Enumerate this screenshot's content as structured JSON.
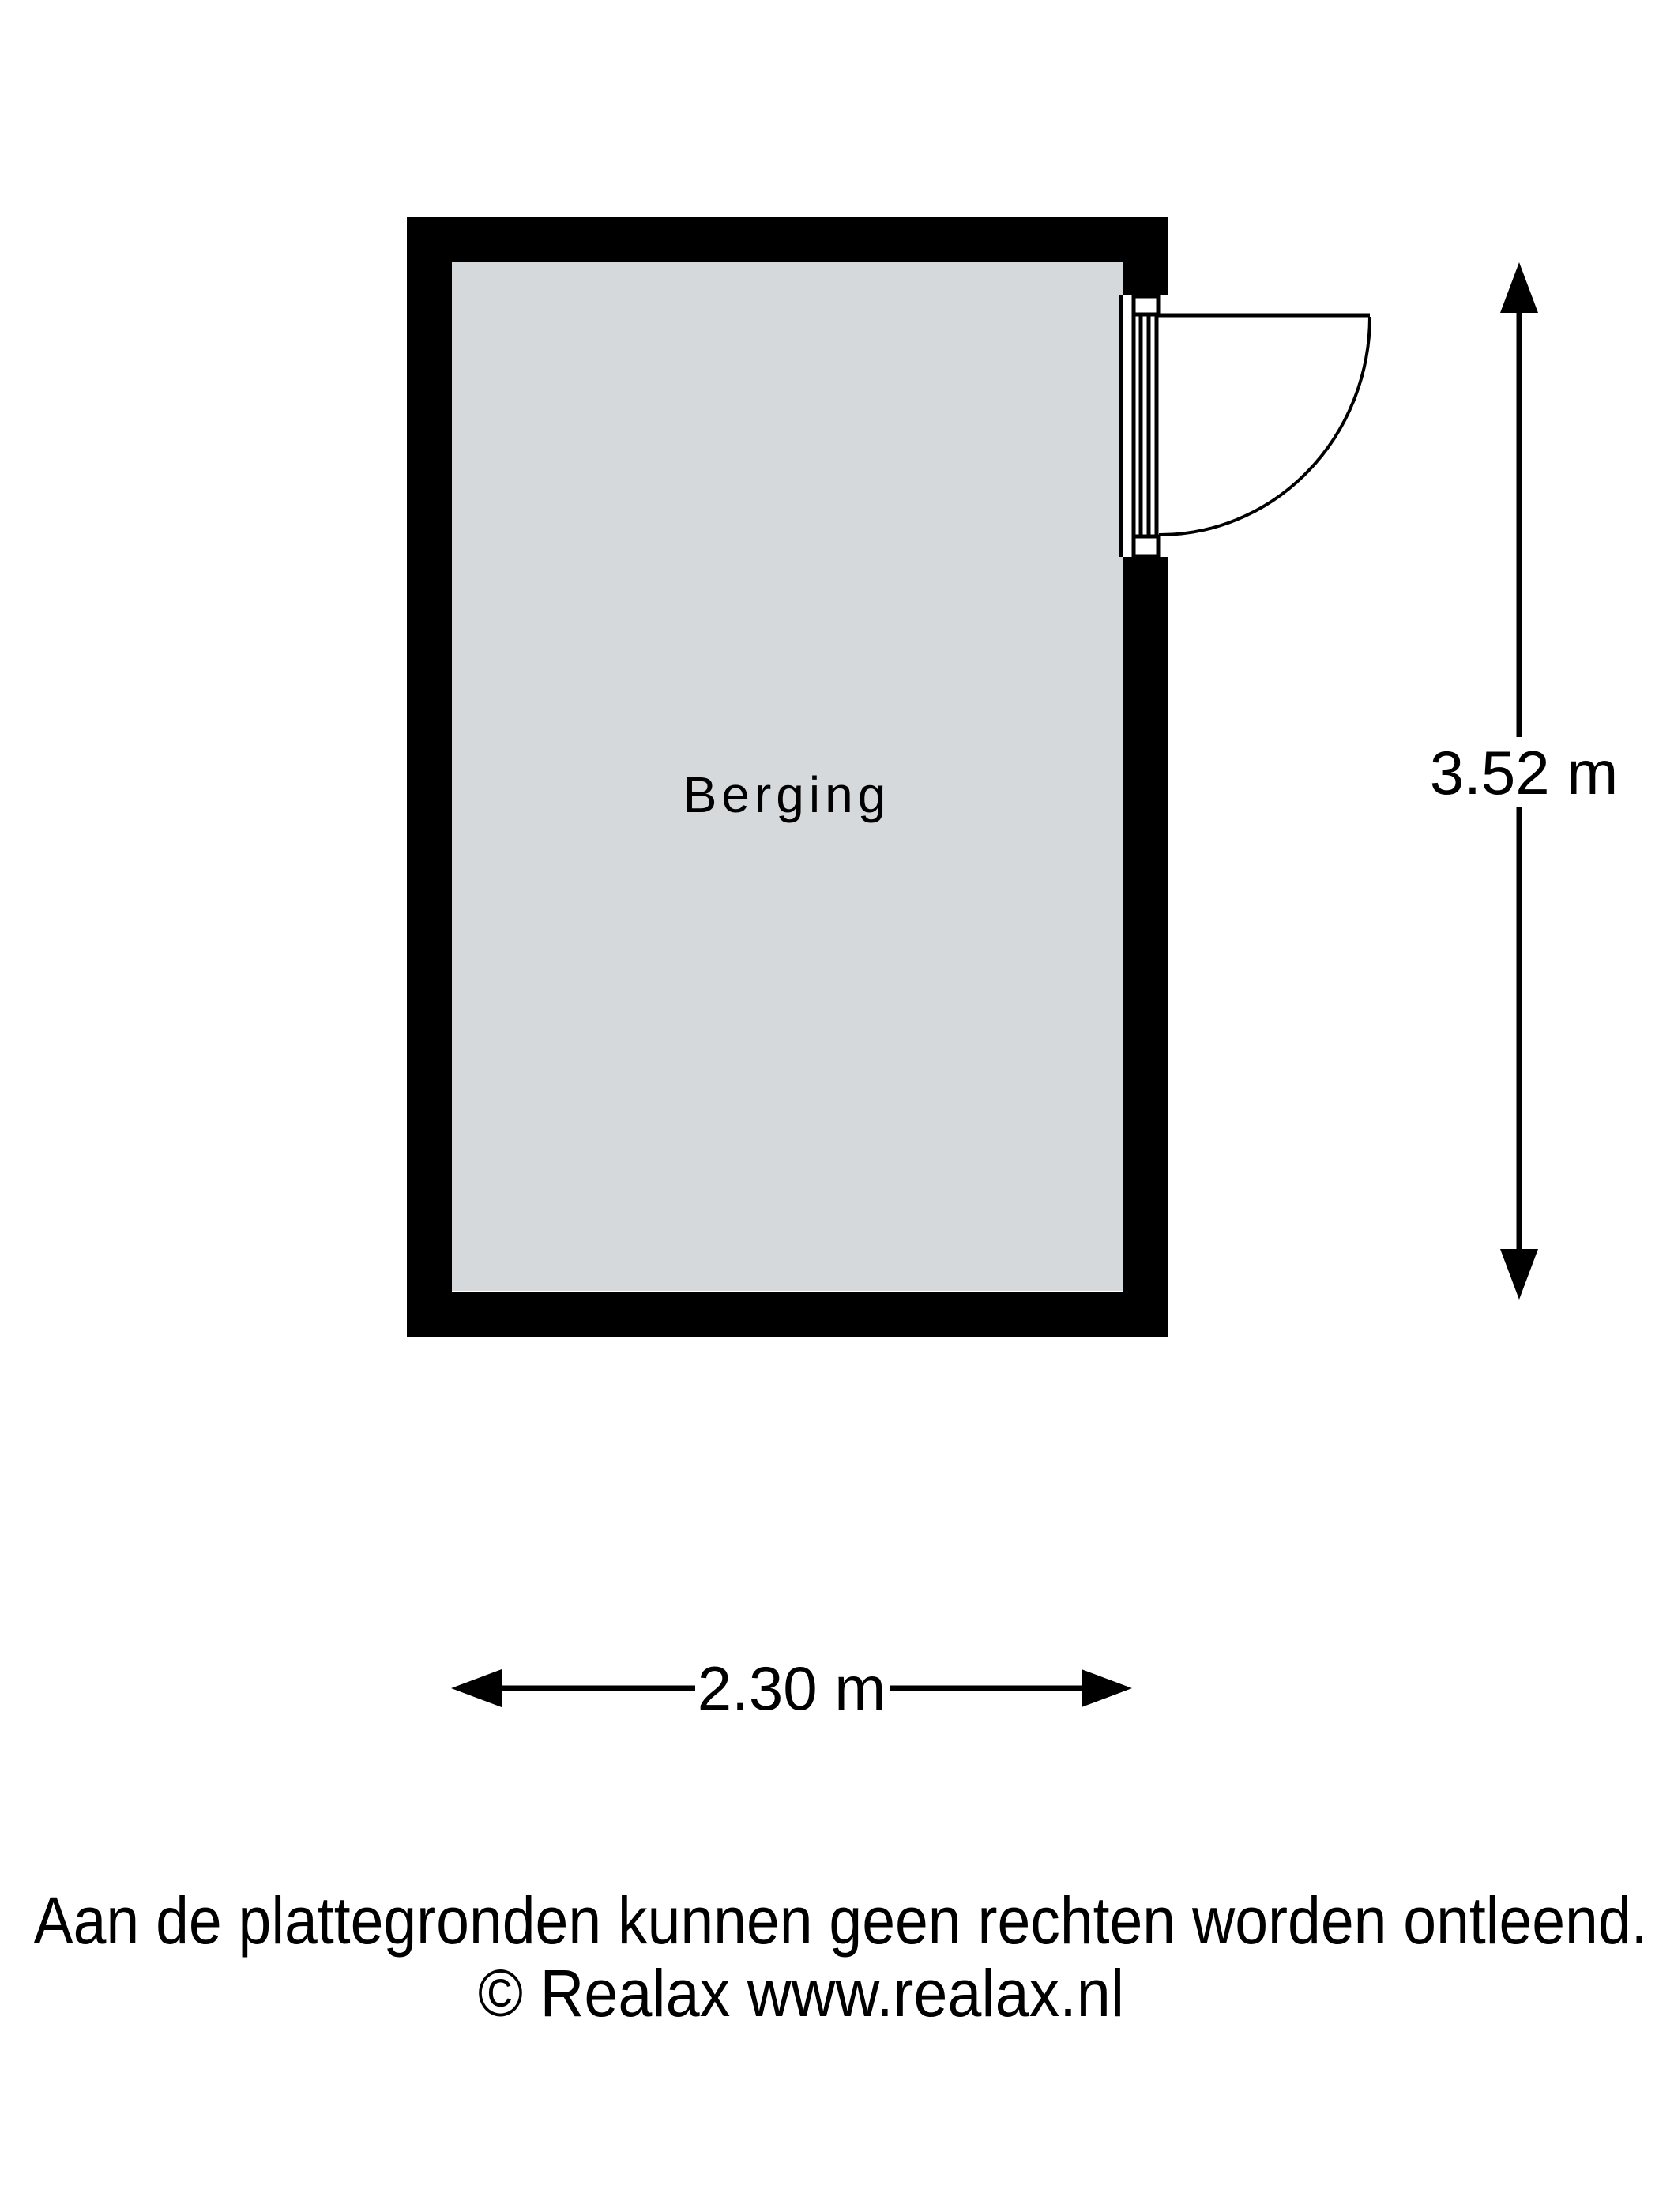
{
  "floorplan": {
    "room": {
      "name": "Berging"
    },
    "dimensions": {
      "height_label": "3.52 m",
      "width_label": "2.30 m"
    },
    "footer": {
      "line1": "Aan de plattegronden kunnen geen rechten worden ontleend.",
      "line2": "© Realax www.realax.nl"
    },
    "colors": {
      "wall": "#000000",
      "floor": "#d5d9dc",
      "background": "#ffffff",
      "lines": "#000000"
    }
  }
}
